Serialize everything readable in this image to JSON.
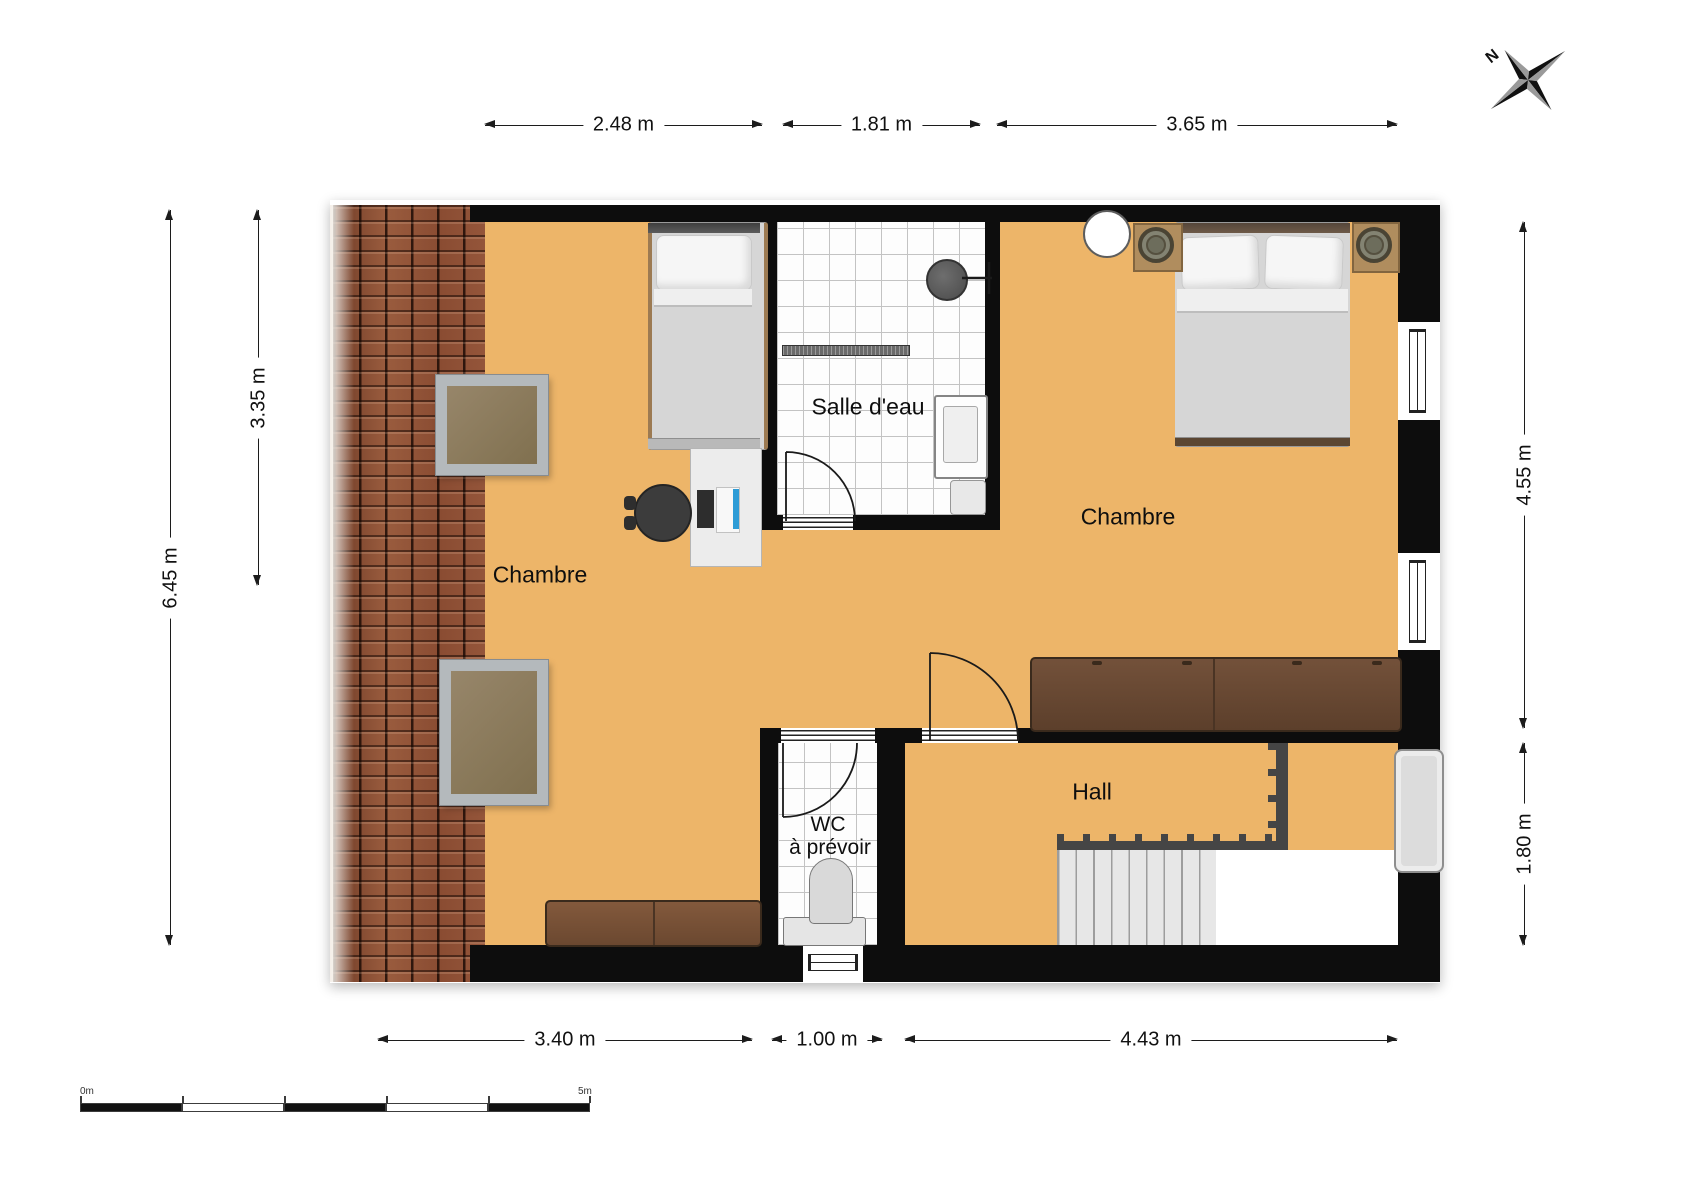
{
  "plan": {
    "rooms": {
      "chambre_left": "Chambre",
      "salle_deau": "Salle d'eau",
      "chambre_right": "Chambre",
      "hall": "Hall",
      "wc_line1": "WC",
      "wc_line2": "à prévoir"
    },
    "dimensions": {
      "top": [
        {
          "label": "2.48 m"
        },
        {
          "label": "1.81 m"
        },
        {
          "label": "3.65 m"
        }
      ],
      "bottom": [
        {
          "label": "3.40 m"
        },
        {
          "label": "1.00 m"
        },
        {
          "label": "4.43 m"
        }
      ],
      "left": [
        {
          "label": "6.45 m"
        },
        {
          "label": "3.35 m"
        }
      ],
      "right": [
        {
          "label": "4.55 m"
        },
        {
          "label": "1.80 m"
        }
      ]
    },
    "scale_bar": {
      "start_label": "0m",
      "end_label": "5m"
    },
    "compass": {
      "north_label": "N"
    },
    "colors": {
      "floor_orange": "#edb569",
      "wall_black": "#0d0d0d",
      "roof_tile": "#8a4f36",
      "wood_dark": "#6b4a33",
      "wood_light": "#7a5538",
      "bathroom_tile": "#fdfdfd",
      "laptop_blue": "#2e9cd6"
    }
  }
}
